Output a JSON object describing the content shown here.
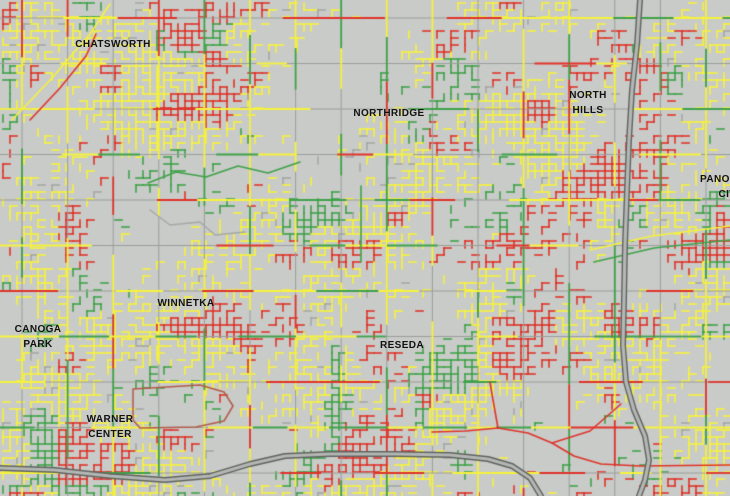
{
  "map": {
    "background_color": "#c9cbc8",
    "label_color": "#111111",
    "street_colors": {
      "yellow": "#f6f23e",
      "red": "#df342b",
      "green": "#3fa24a",
      "minor_gray": "#a5a8a5",
      "arterial_gray": "#9b9e9b",
      "outline_brown": "#b25b4a"
    },
    "freeway_colors": {
      "core": "#b4b7b4",
      "casing": "#606460"
    },
    "labels": [
      {
        "name": "chatsworth",
        "line1": "CHATSWORTH"
      },
      {
        "name": "northridge",
        "line1": "NORTHRIDGE"
      },
      {
        "name": "north-hills",
        "line1": "NORTH",
        "line2": "HILLS"
      },
      {
        "name": "panorama-city",
        "line1": "PANORAMA",
        "line2": "CITY"
      },
      {
        "name": "winnetka",
        "line1": "WINNETKA"
      },
      {
        "name": "canoga-park",
        "line1": "CANOGA",
        "line2": "PARK"
      },
      {
        "name": "reseda",
        "line1": "RESEDA"
      },
      {
        "name": "warner-center",
        "line1": "WARNER",
        "line2": "CENTER"
      }
    ],
    "network": {
      "seed": 20,
      "residential": {
        "cell": 7,
        "base_density": 1.35,
        "red_threshold": 0.66,
        "green_threshold": 0.72,
        "green_threshold_sw": 0.55,
        "minor_gray_chance": 0.05,
        "extra_branch_chance": 0.42
      },
      "arterials": {
        "x_start": 22,
        "x_step": 45.6,
        "y_start": 18,
        "y_step": 45.5,
        "chunk_min": 28,
        "chunk_max": 64,
        "weights": {
          "none": 0.38,
          "yellow": 0.34,
          "red": 0.1,
          "green": 0.18
        }
      },
      "sparse_zones": [
        {
          "name": "sepulveda-basin",
          "cx": 545,
          "cy": 450,
          "rx": 118,
          "ry": 68,
          "f": 0.02
        },
        {
          "name": "country-club",
          "cx": 178,
          "cy": 408,
          "rx": 50,
          "ry": 26,
          "f": 0.04
        },
        {
          "name": "csun-area",
          "cx": 352,
          "cy": 168,
          "rx": 58,
          "ry": 36,
          "f": 0.3
        },
        {
          "name": "chatsworth-mid",
          "cx": 185,
          "cy": 185,
          "rx": 95,
          "ry": 52,
          "f": 0.38
        },
        {
          "name": "golf-strip",
          "cx": 250,
          "cy": 455,
          "rx": 62,
          "ry": 26,
          "f": 0.15
        }
      ]
    },
    "roads": [
      {
        "name": "basin-road-a",
        "color": "red",
        "width": 1.6,
        "path": [
          [
            432,
            432
          ],
          [
            466,
            431
          ],
          [
            498,
            428
          ],
          [
            528,
            433
          ],
          [
            552,
            443
          ],
          [
            574,
            456
          ],
          [
            601,
            464
          ],
          [
            640,
            466
          ],
          [
            730,
            465
          ]
        ]
      },
      {
        "name": "basin-road-b",
        "color": "red",
        "width": 1.6,
        "path": [
          [
            552,
            443
          ],
          [
            590,
            431
          ],
          [
            621,
            404
          ]
        ]
      },
      {
        "name": "basin-road-c",
        "color": "red",
        "width": 1.6,
        "path": [
          [
            498,
            428
          ],
          [
            493,
            400
          ],
          [
            490,
            382
          ]
        ]
      },
      {
        "name": "country-club-loop",
        "color": "outline_brown",
        "width": 1.5,
        "path": [
          [
            133,
            389
          ],
          [
            200,
            385
          ],
          [
            224,
            392
          ],
          [
            233,
            406
          ],
          [
            224,
            421
          ],
          [
            196,
            427
          ],
          [
            140,
            428
          ],
          [
            133,
            420
          ],
          [
            133,
            389
          ]
        ]
      },
      {
        "name": "chatsworth-collector",
        "color": "green",
        "width": 1.6,
        "path": [
          [
            148,
            183
          ],
          [
            176,
            172
          ],
          [
            206,
            177
          ],
          [
            238,
            166
          ],
          [
            268,
            173
          ],
          [
            300,
            162
          ]
        ]
      },
      {
        "name": "reseda-green-street",
        "color": "green",
        "width": 1.6,
        "path": [
          [
            361,
            186
          ],
          [
            361,
            262
          ]
        ]
      },
      {
        "name": "nw-diagonal-yellow",
        "color": "yellow",
        "width": 1.6,
        "path": [
          [
            12,
            120
          ],
          [
            52,
            78
          ],
          [
            90,
            34
          ],
          [
            110,
            4
          ]
        ]
      },
      {
        "name": "nw-diagonal-red",
        "color": "red",
        "width": 1.6,
        "path": [
          [
            30,
            120
          ],
          [
            60,
            88
          ],
          [
            86,
            56
          ],
          [
            96,
            34
          ]
        ]
      },
      {
        "name": "east-diagonal-yellow",
        "color": "yellow",
        "width": 1.6,
        "path": [
          [
            590,
            250
          ],
          [
            652,
            236
          ],
          [
            730,
            226
          ]
        ]
      },
      {
        "name": "east-diagonal-green",
        "color": "green",
        "width": 1.6,
        "path": [
          [
            594,
            262
          ],
          [
            654,
            248
          ],
          [
            730,
            240
          ]
        ]
      },
      {
        "name": "sparse-loop-road",
        "color": "minor_gray",
        "width": 1.4,
        "path": [
          [
            150,
            210
          ],
          [
            170,
            225
          ],
          [
            200,
            222
          ],
          [
            215,
            235
          ],
          [
            245,
            232
          ]
        ]
      }
    ],
    "freeways": [
      {
        "name": "horizontal-freeway",
        "path": [
          [
            0,
            468
          ],
          [
            55,
            470
          ],
          [
            110,
            476
          ],
          [
            165,
            480
          ],
          [
            210,
            476
          ],
          [
            250,
            464
          ],
          [
            285,
            456
          ],
          [
            330,
            454
          ],
          [
            395,
            454
          ],
          [
            450,
            455
          ],
          [
            488,
            459
          ],
          [
            512,
            466
          ],
          [
            530,
            478
          ],
          [
            541,
            496
          ]
        ]
      },
      {
        "name": "vertical-freeway",
        "path": [
          [
            640,
            0
          ],
          [
            637,
            45
          ],
          [
            632,
            90
          ],
          [
            629,
            140
          ],
          [
            627,
            190
          ],
          [
            625,
            245
          ],
          [
            624,
            300
          ],
          [
            623,
            345
          ],
          [
            626,
            382
          ],
          [
            634,
            410
          ],
          [
            645,
            436
          ],
          [
            649,
            460
          ],
          [
            645,
            480
          ],
          [
            639,
            496
          ]
        ]
      }
    ]
  }
}
